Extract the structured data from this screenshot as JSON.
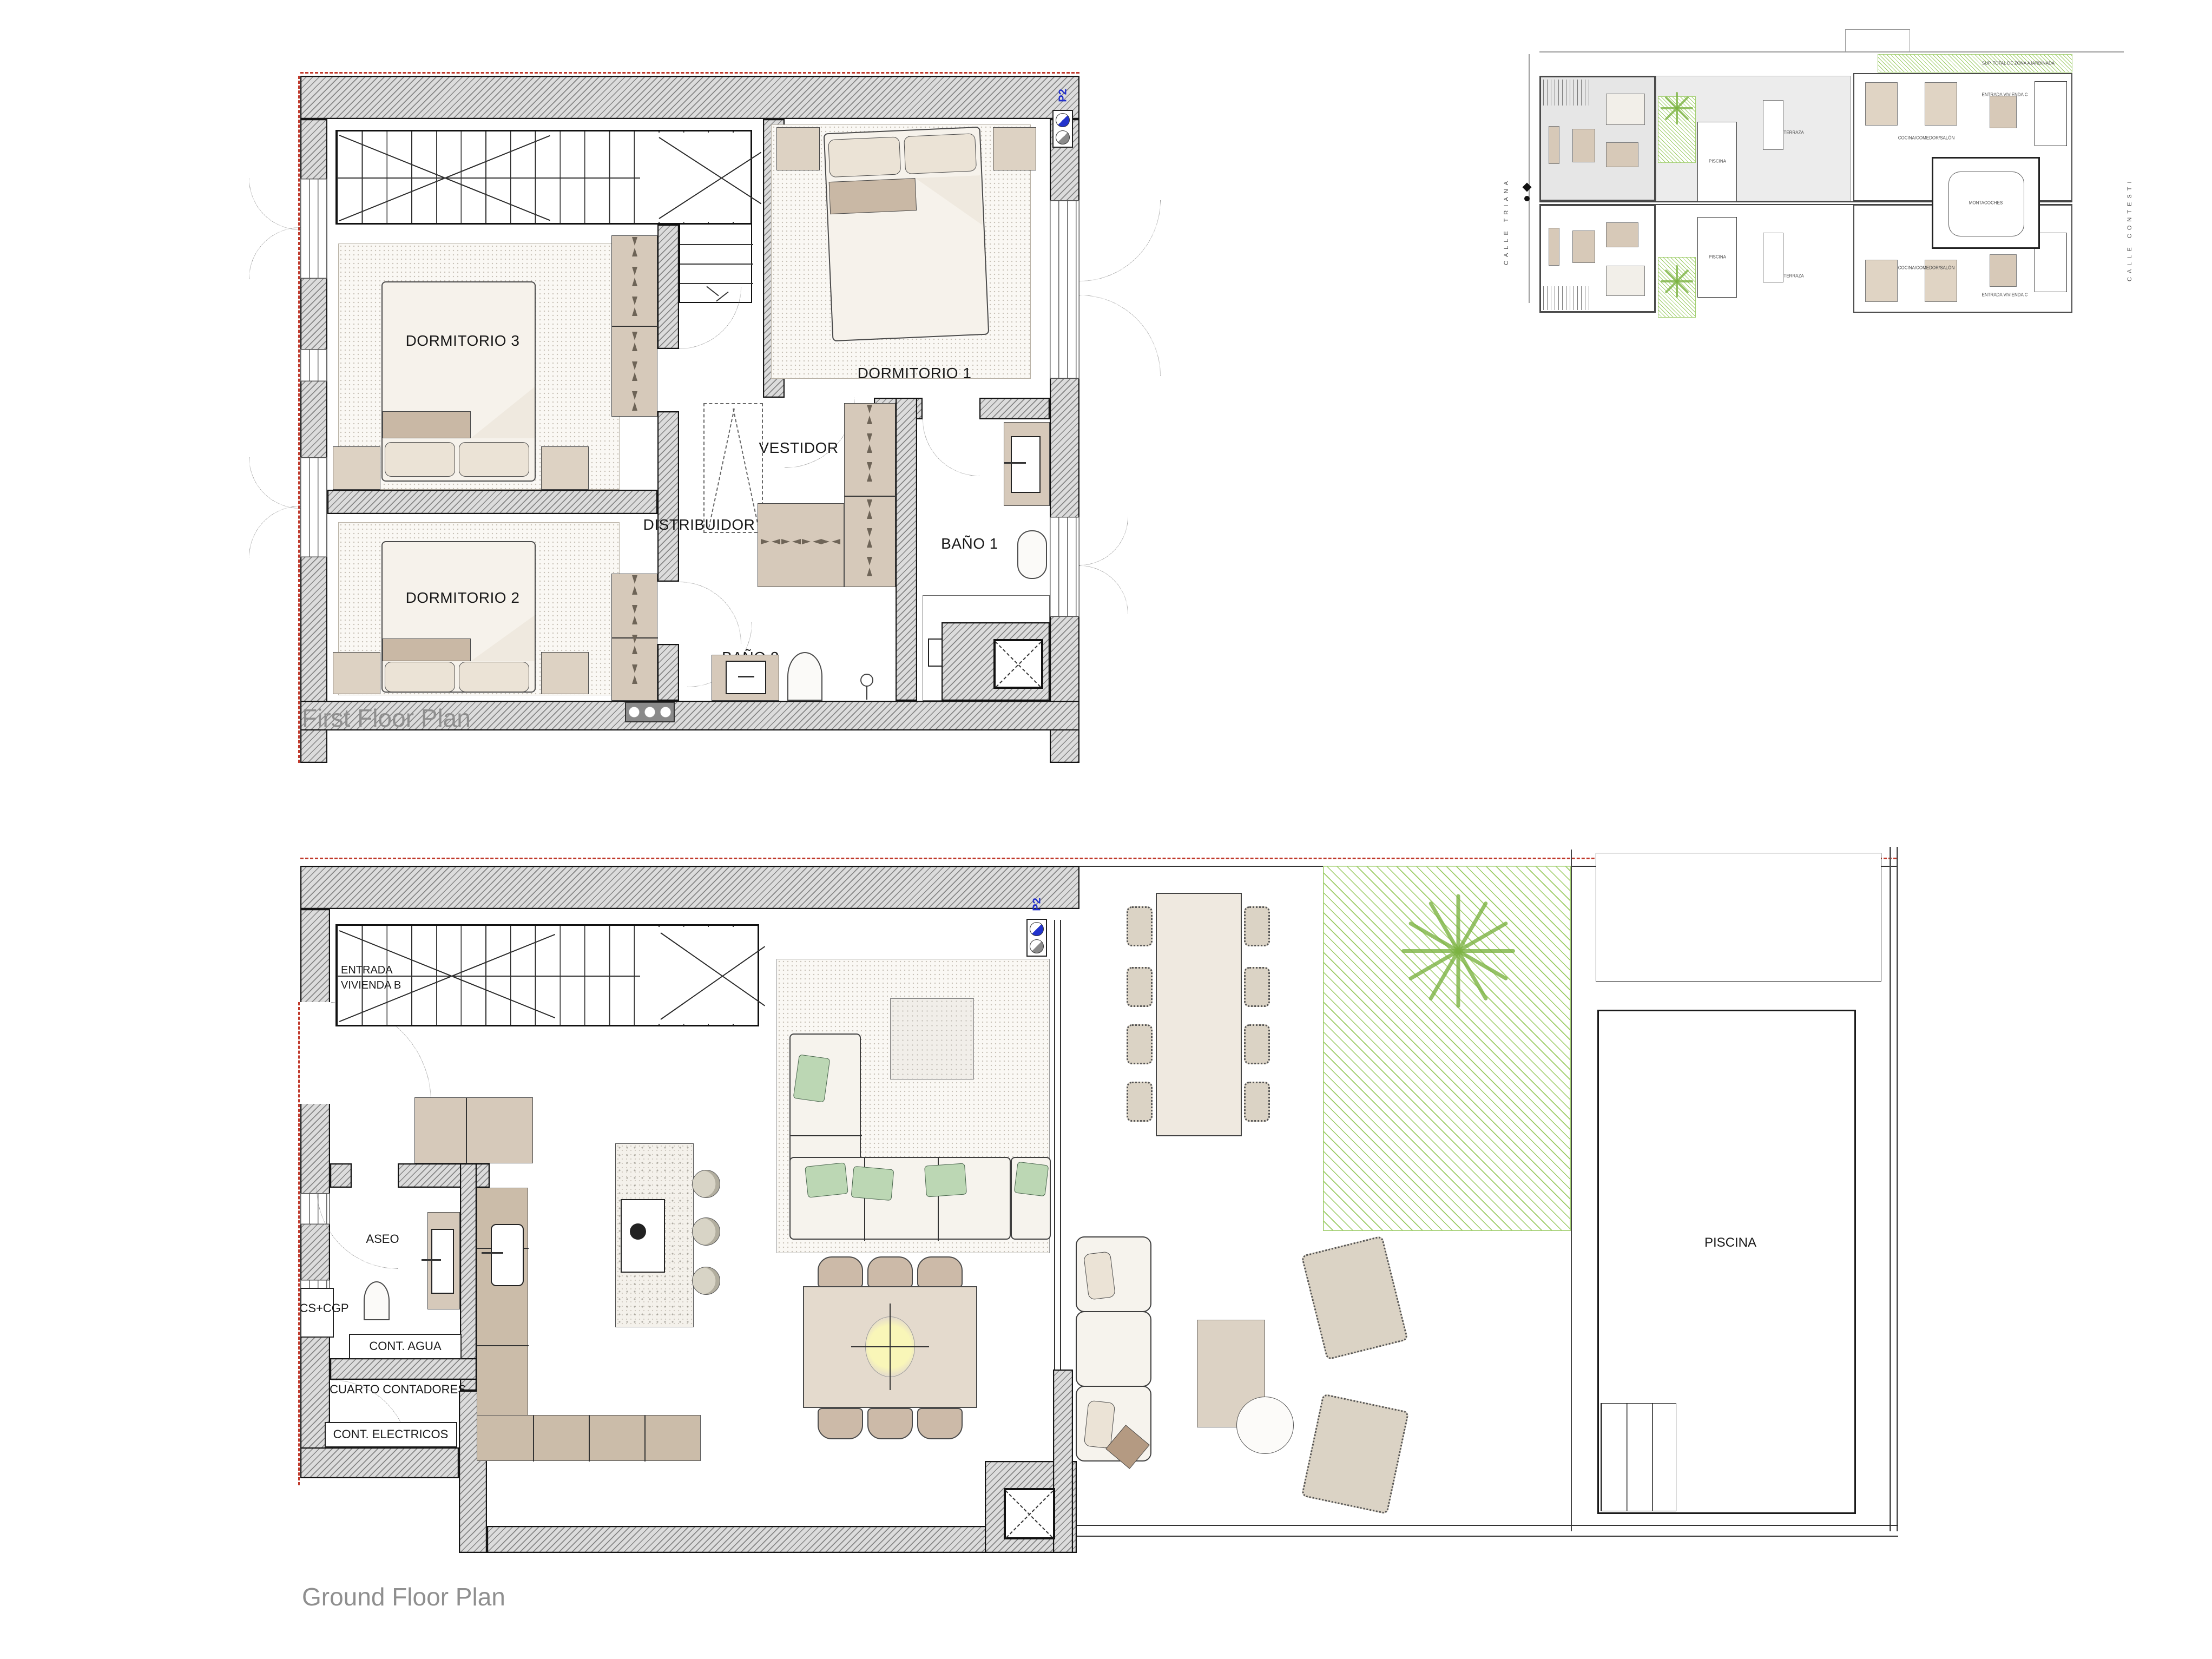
{
  "first_floor": {
    "caption": "First Floor Plan",
    "marker": "P2",
    "rooms": {
      "dorm1": "DORMITORIO 1",
      "dorm2": "DORMITORIO 2",
      "dorm3": "DORMITORIO 3",
      "vestidor": "VESTIDOR",
      "distribuidor": "DISTRIBUIDOR",
      "bano1": "BAÑO 1",
      "bano2": "BAÑO 2"
    }
  },
  "ground_floor": {
    "caption": "Ground Floor Plan",
    "marker": "P2",
    "rooms": {
      "entrada_line1": "ENTRADA",
      "entrada_line2": "VIVIENDA B",
      "aseo": "ASEO",
      "cscgp": "CS+CGP",
      "cont_agua": "CONT. AGUA",
      "cuarto_contadores": "CUARTO CONTADORES",
      "cont_electricos": "CONT. ELECTRICOS",
      "cocina": "COCINA/COMEDOR/SALÓN",
      "piscina": "PISCINA"
    }
  },
  "site_plan": {
    "street_left": "CALLE TRIANA",
    "street_right": "CALLE CONTESTI",
    "montacoches": "MONTACOCHES",
    "terraza": "TERRAZA",
    "piscina": "PISCINA",
    "cocina": "COCINA/COMEDOR/SALÓN",
    "entrada_c": "ENTRADA VIVIENDA C",
    "zona": "SUP. TOTAL DE ZONA AJARDINADA"
  },
  "colors": {
    "wall_hatch": "#dcdcdc",
    "garden_green": "#8bc34a",
    "property_line_red": "#c0392b",
    "marker_blue": "#2233cc",
    "caption_gray": "#8f8f8f",
    "furniture_beige": "#d6c9ba"
  }
}
